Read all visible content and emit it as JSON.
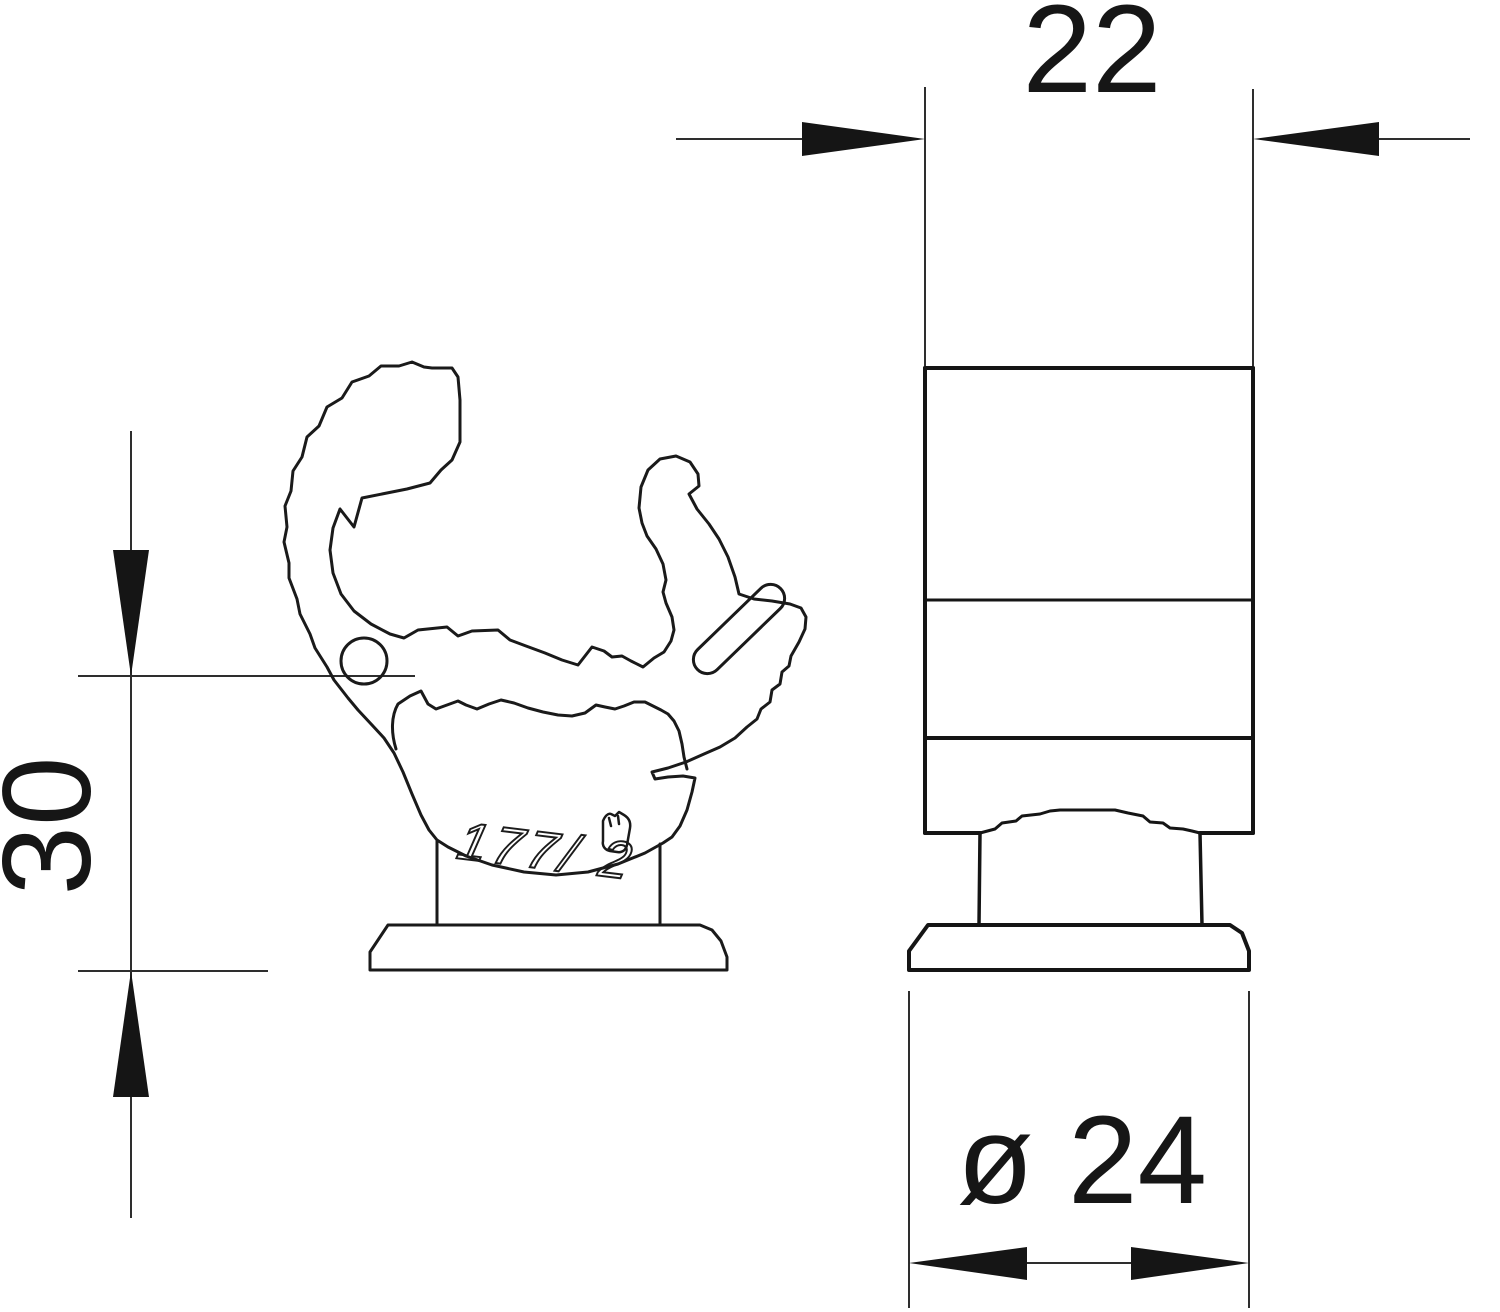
{
  "drawing": {
    "type": "technical-dimension-drawing",
    "views": {
      "front_view": {
        "description": "pipe-clamp front outline",
        "marking": "177/ 2"
      },
      "side_view": {
        "description": "pipe-clamp side outline"
      }
    },
    "dimensions": {
      "top_width": {
        "label": "22"
      },
      "left_height": {
        "label": "30"
      },
      "bottom_diameter": {
        "label": "ø 24"
      }
    },
    "colors": {
      "background": "#ffffff",
      "outline": "#1a1a1a",
      "dimension_lines": "#2e2e2e",
      "text": "#161616"
    }
  }
}
